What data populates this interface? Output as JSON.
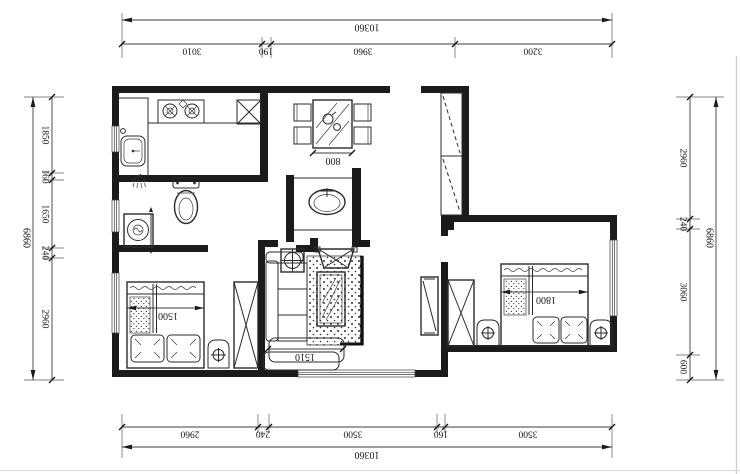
{
  "meta": {
    "drawing_type": "apartment floor plan (CAD line drawing, sheet rotated 180 degrees so all text reads upside-down)",
    "units": "millimeters"
  },
  "colors": {
    "background": "#ffffff",
    "line": "#2b2b2b",
    "wall_fill": "#1b1b1b",
    "dim_line": "#3c3c3c"
  },
  "dimensions": {
    "top": {
      "total": "10360",
      "segments": [
        "3010",
        "190",
        "3960",
        "3200"
      ]
    },
    "bottom": {
      "total": "10360",
      "segments": [
        "2960",
        "240",
        "3500",
        "160",
        "3500"
      ]
    },
    "left": {
      "total": "6860",
      "segments": [
        "1850",
        "160",
        "1650",
        "240",
        "2960"
      ]
    },
    "right": {
      "total": "6860",
      "segments": [
        "2960",
        "240",
        "3060",
        "600"
      ]
    }
  },
  "furniture": {
    "dining_table": {
      "label": "800"
    },
    "bed_small": {
      "label": "1500"
    },
    "sofa": {
      "label": "1510"
    },
    "bed_large": {
      "label": "1800"
    }
  },
  "icons": [
    "stove-icon",
    "kitchen-sink-icon",
    "cabinet-x-icon",
    "shower-icon",
    "toilet-icon",
    "basin-icon",
    "washing-machine-icon",
    "dining-set-icon",
    "closet-dashed-icon",
    "wardrobe-x-icon",
    "tv-stand-icon",
    "plant-stand-icon",
    "sofa-icon",
    "coffee-table-icon",
    "rug-icon",
    "bed-icon",
    "nightstand-icon",
    "window-icon"
  ]
}
